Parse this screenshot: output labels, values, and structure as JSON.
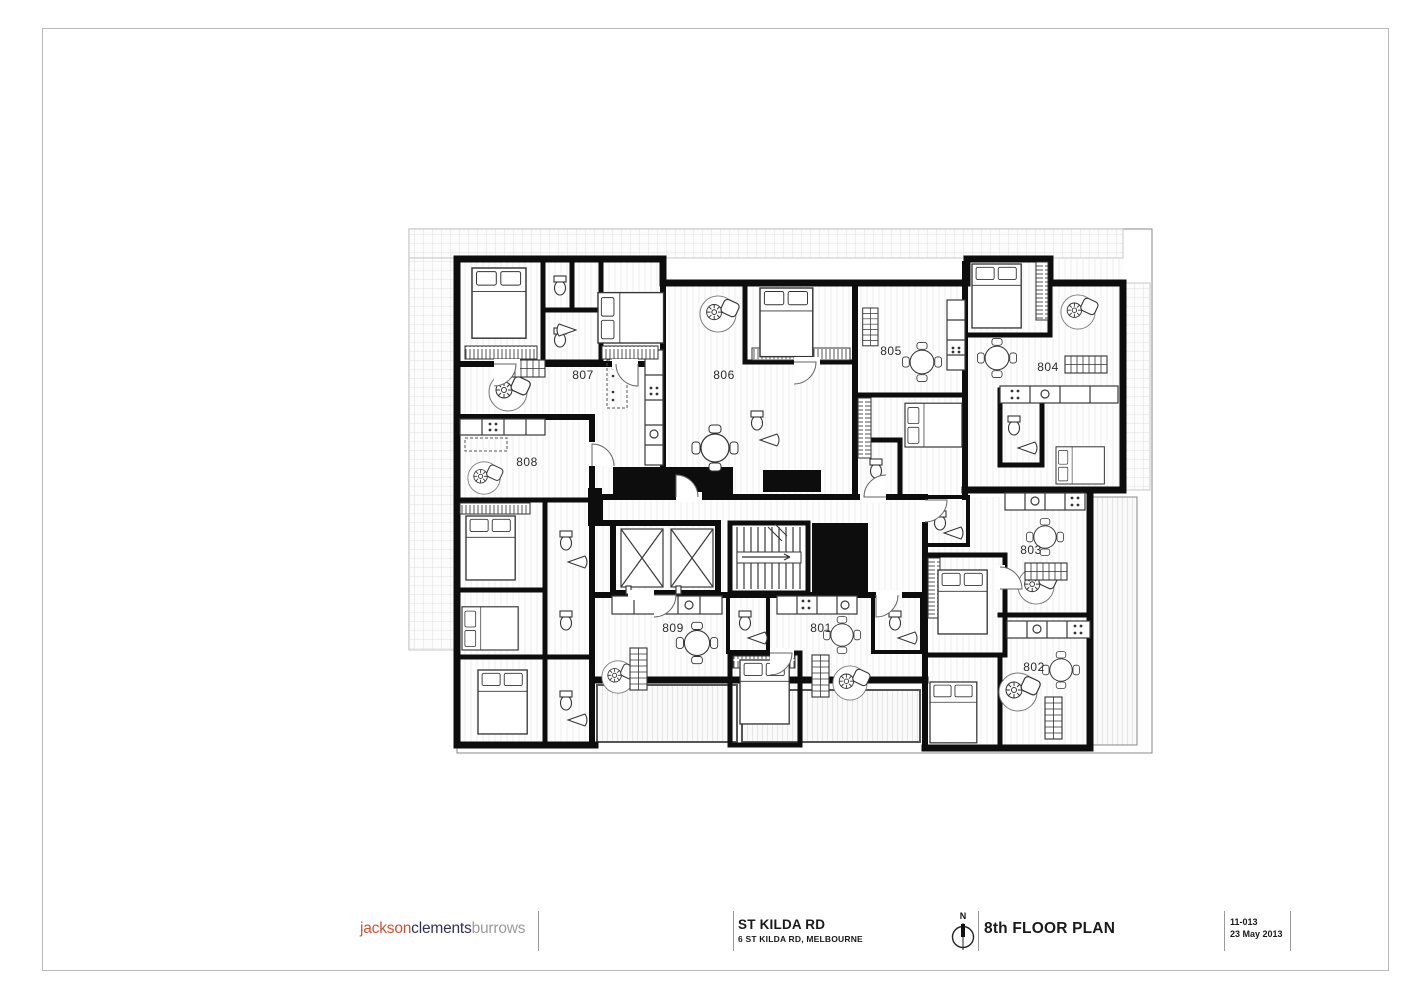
{
  "sheet": {
    "border_color": "#b9b9b9"
  },
  "plan": {
    "apartments": [
      {
        "number": "807",
        "x": 583,
        "y": 379
      },
      {
        "number": "806",
        "x": 724,
        "y": 379
      },
      {
        "number": "805",
        "x": 891,
        "y": 355
      },
      {
        "number": "804",
        "x": 1048,
        "y": 371
      },
      {
        "number": "808",
        "x": 527,
        "y": 466
      },
      {
        "number": "803",
        "x": 1031,
        "y": 554
      },
      {
        "number": "809",
        "x": 673,
        "y": 632
      },
      {
        "number": "801",
        "x": 821,
        "y": 632
      },
      {
        "number": "802",
        "x": 1034,
        "y": 671
      }
    ]
  },
  "title_block": {
    "logo": {
      "part1": "jackson",
      "part2": "clements",
      "part3": "burrows",
      "color1": "#d4502e",
      "color2": "#30305c",
      "color3": "#9b9b9b"
    },
    "project_title": "ST KILDA RD",
    "project_subtitle": "6 ST KILDA RD, MELBOURNE",
    "compass_label": "N",
    "drawing_title": "8th FLOOR PLAN",
    "drawing_number": "11-013",
    "drawing_date": "23 May 2013"
  }
}
